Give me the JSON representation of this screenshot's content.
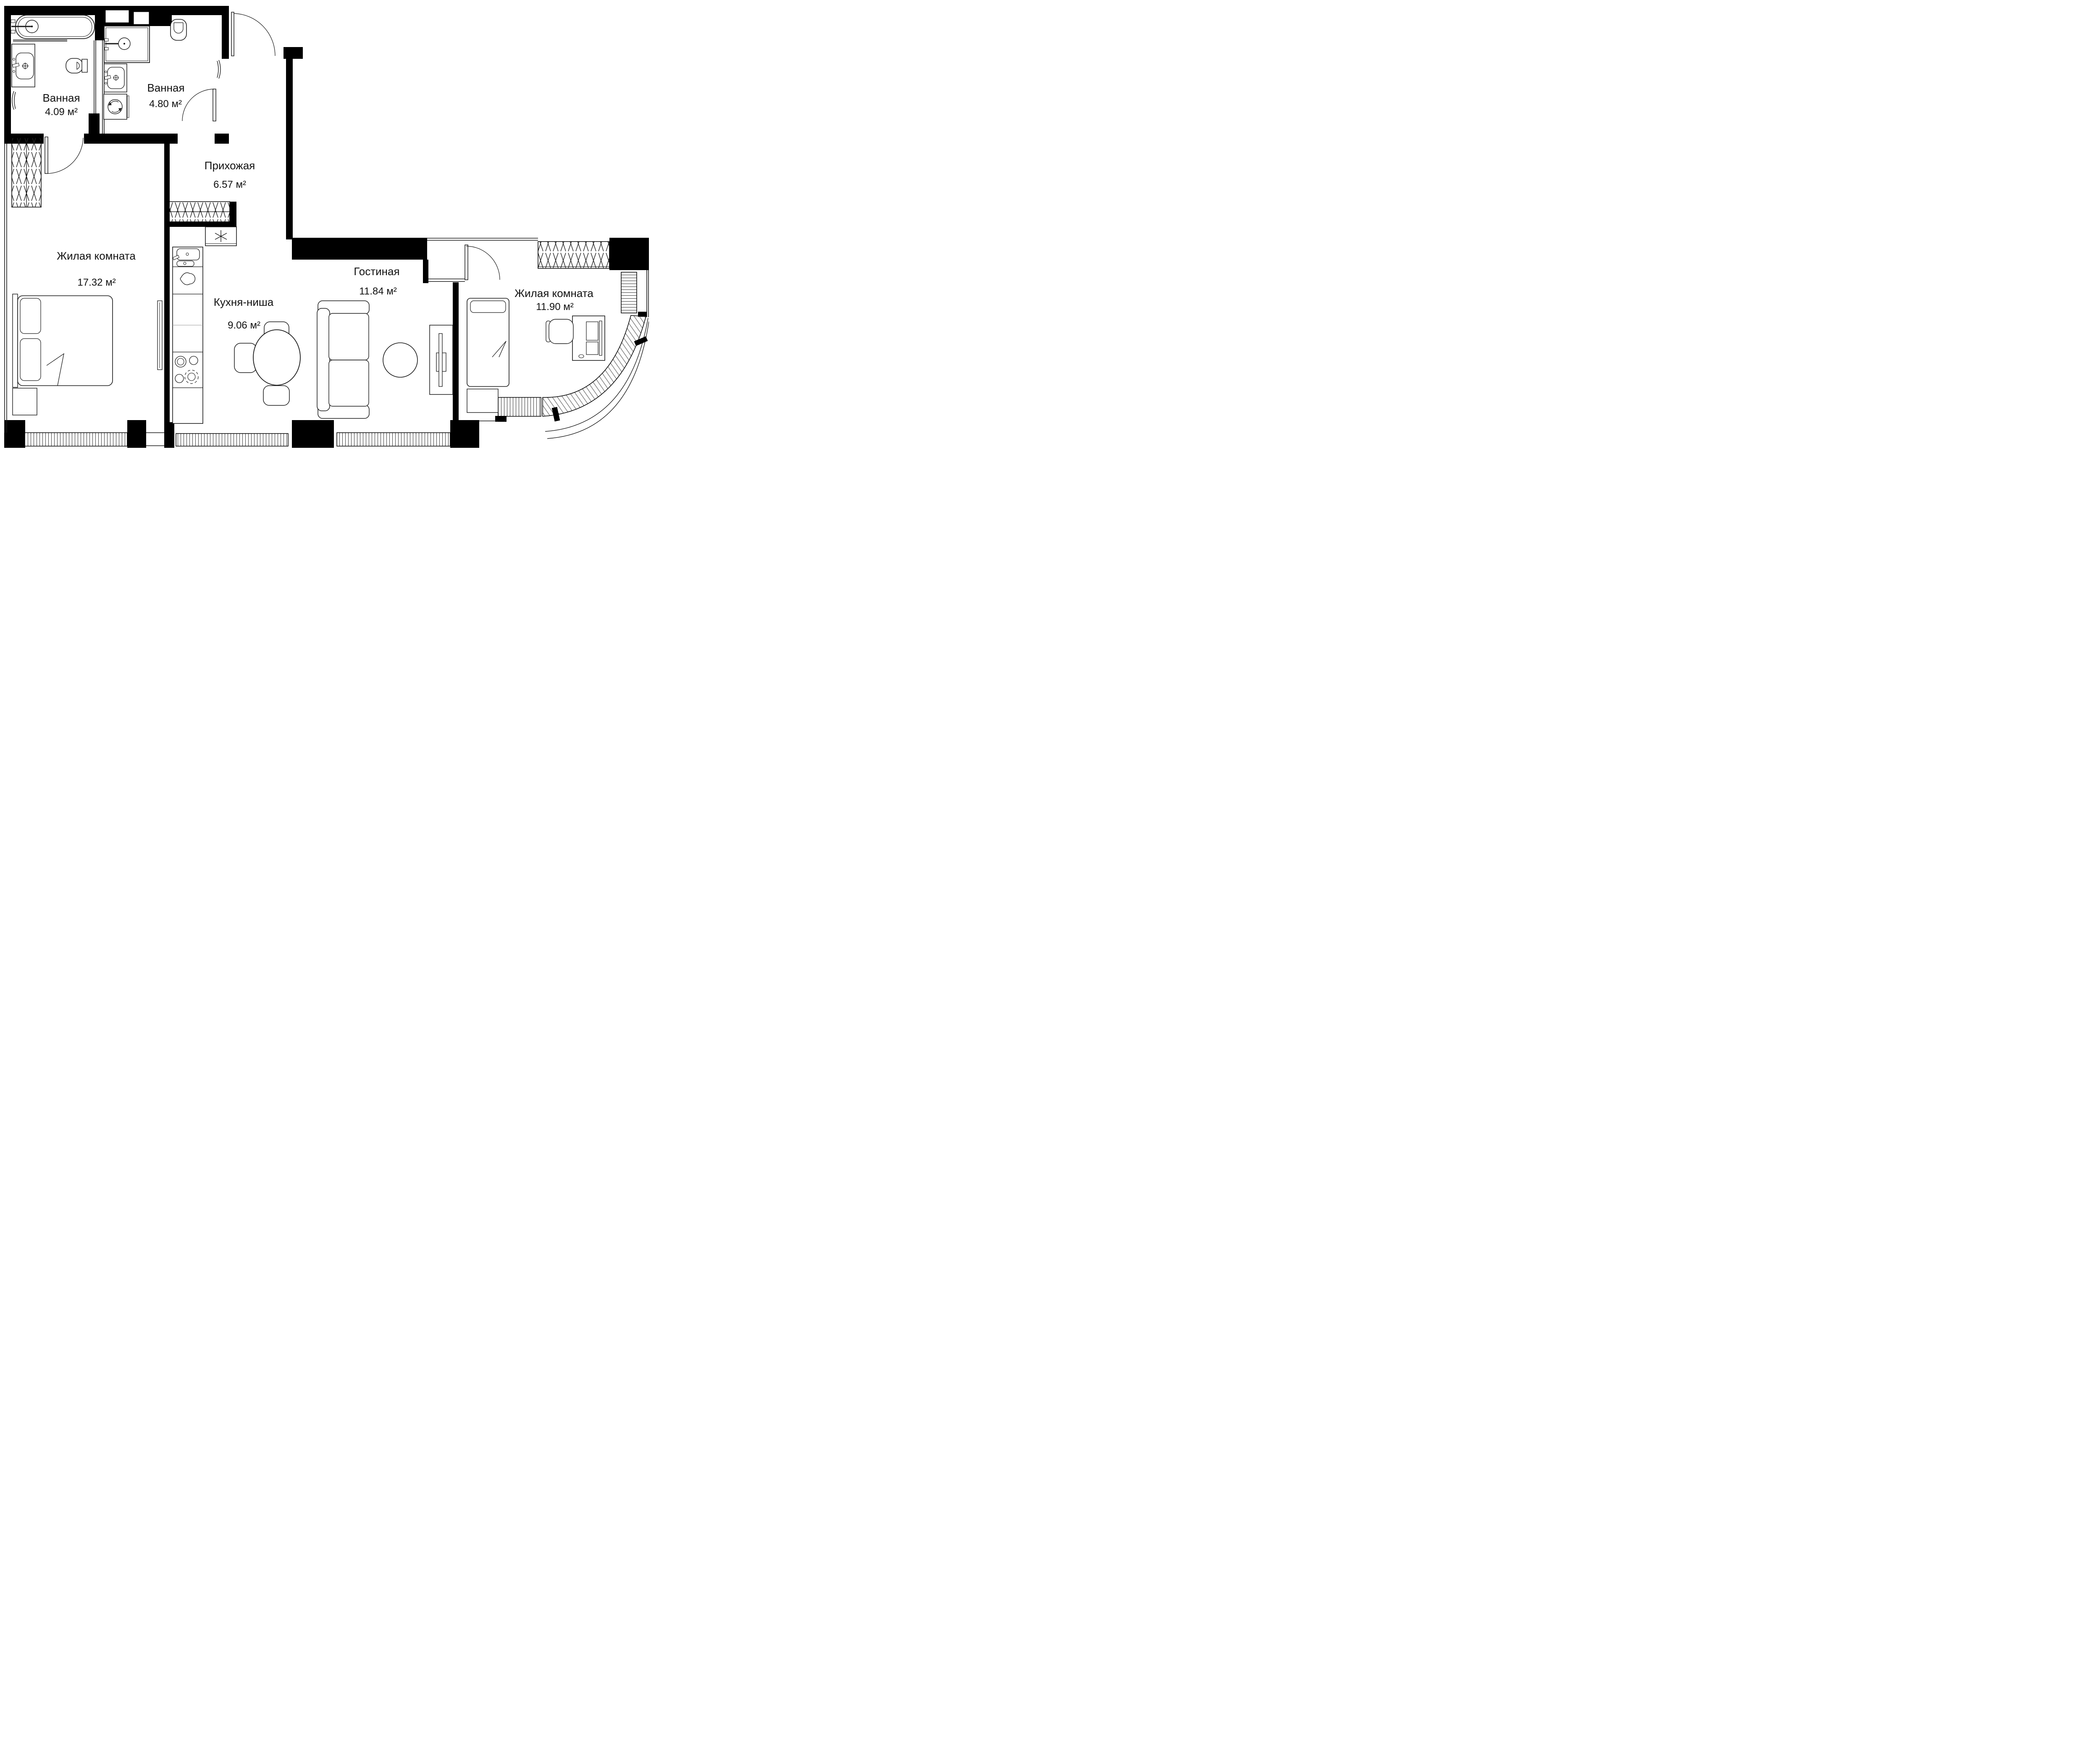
{
  "plan_title": "Apartment floor plan",
  "units_suffix": "м²",
  "colors": {
    "walls": "#000000",
    "lines": "#1a1a1a",
    "background": "#ffffff",
    "text": "#111111"
  },
  "rooms": [
    {
      "id": "bathroom-1",
      "name": "Ванная",
      "area_label": "4.09 м²"
    },
    {
      "id": "bathroom-2",
      "name": "Ванная",
      "area_label": "4.80 м²"
    },
    {
      "id": "hallway",
      "name": "Прихожая",
      "area_label": "6.57 м²"
    },
    {
      "id": "living-room-1",
      "name": "Жилая комната",
      "area_label": "17.32 м²"
    },
    {
      "id": "kitchen-niche",
      "name": "Кухня-ниша",
      "area_label": "9.06 м²"
    },
    {
      "id": "lounge",
      "name": "Гостиная",
      "area_label": "11.84 м²"
    },
    {
      "id": "living-room-2",
      "name": "Жилая комната",
      "area_label": "11.90 м²"
    }
  ],
  "fixture_types": [
    "bathtub",
    "shower",
    "toilet",
    "sink",
    "washing-machine",
    "towel-rail",
    "wardrobe",
    "bed",
    "pillow",
    "dining-table",
    "chair",
    "sofa",
    "coffee-table",
    "tv-stand",
    "desk",
    "desk-chair",
    "fridge",
    "stove",
    "kitchen-sink",
    "kitchen-counter",
    "window",
    "door",
    "mirror",
    "curved-glass-facade"
  ]
}
